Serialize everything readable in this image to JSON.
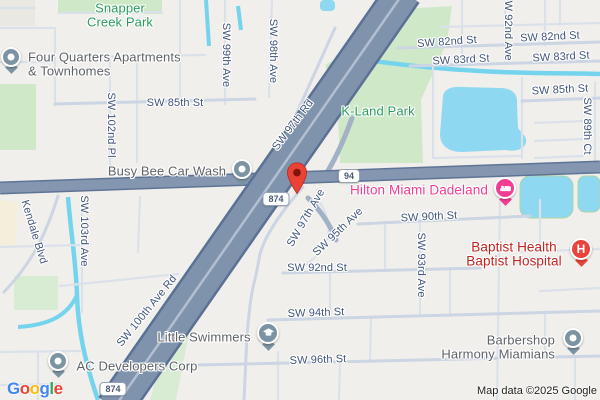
{
  "attribution": "Map data ©2025 Google",
  "logo": {
    "l1": "G",
    "l2": "o",
    "l3": "o",
    "l4": "g",
    "l5": "l",
    "l6": "e"
  },
  "routes": {
    "sr94": "94",
    "sr874": "874"
  },
  "streets": {
    "sw_82nd_st": "SW 82nd St",
    "sw_83rd_st": "SW 83rd St",
    "sw_85th_st": "SW 85th St",
    "sw_90th_st": "SW 90th St",
    "sw_92nd_st": "SW 92nd St",
    "sw_94th_st": "SW 94th St",
    "sw_96th_st": "SW 96th St",
    "sw_89th_ct": "SW 89th Ct",
    "sw_92nd_ave": "SW 92nd Ave",
    "sw_93rd_ave": "SW 93rd Ave",
    "sw_95th_ave": "SW 95th Ave",
    "sw_97th_ave": "SW 97th Ave",
    "sw_97th_rd": "SW 97th Rd",
    "sw_98th_ave": "SW 98th Ave",
    "sw_99th_ave": "SW 99th Ave",
    "sw_102nd_pl": "SW 102nd Pl",
    "sw_103rd_ave": "SW 103rd Ave",
    "sw_100th_ave_rd": "SW 100th Ave Rd",
    "kendale_blvd": "Kendale Blvd"
  },
  "places": {
    "snapper_creek_park": {
      "line1": "Snapper",
      "line2": "Creek Park"
    },
    "k_land_park": {
      "name": "K-Land Park"
    },
    "four_quarters": {
      "line1": "Four Quarters Apartments",
      "line2": "& Townhomes"
    },
    "busy_bee": {
      "name": "Busy Bee Car Wash"
    },
    "hilton": {
      "name": "Hilton Miami Dadeland"
    },
    "baptist_hospital": {
      "line1": "Baptist Health",
      "line2": "Baptist Hospital"
    },
    "barbershop": {
      "line1": "Barbershop",
      "line2": "Harmony Miamians"
    },
    "little_swimmers": {
      "name": "Little Swimmers"
    },
    "ac_developers": {
      "name": "AC Developers Corp"
    }
  },
  "icons": {
    "hospital_glyph": "H"
  },
  "colors": {
    "highway_fill": "#8093ad",
    "highway_casing": "#5a7194",
    "arterial_fill": "#8496b0",
    "minor_road": "#dbe1eb",
    "collector_road": "#ccd5e3",
    "water": "#8ed8f1",
    "canal": "#74d4ee",
    "park": "#cfe9c8",
    "street_label": "#41557c",
    "park_label": "#2a9d5c",
    "poi_label": "#5f6368",
    "lodging_pink": "#f23e92",
    "hospital_red": "#c5221f",
    "pin_grey": "#7c93a3",
    "destination_pin": "#ea4335",
    "background": "#f1efeb"
  }
}
